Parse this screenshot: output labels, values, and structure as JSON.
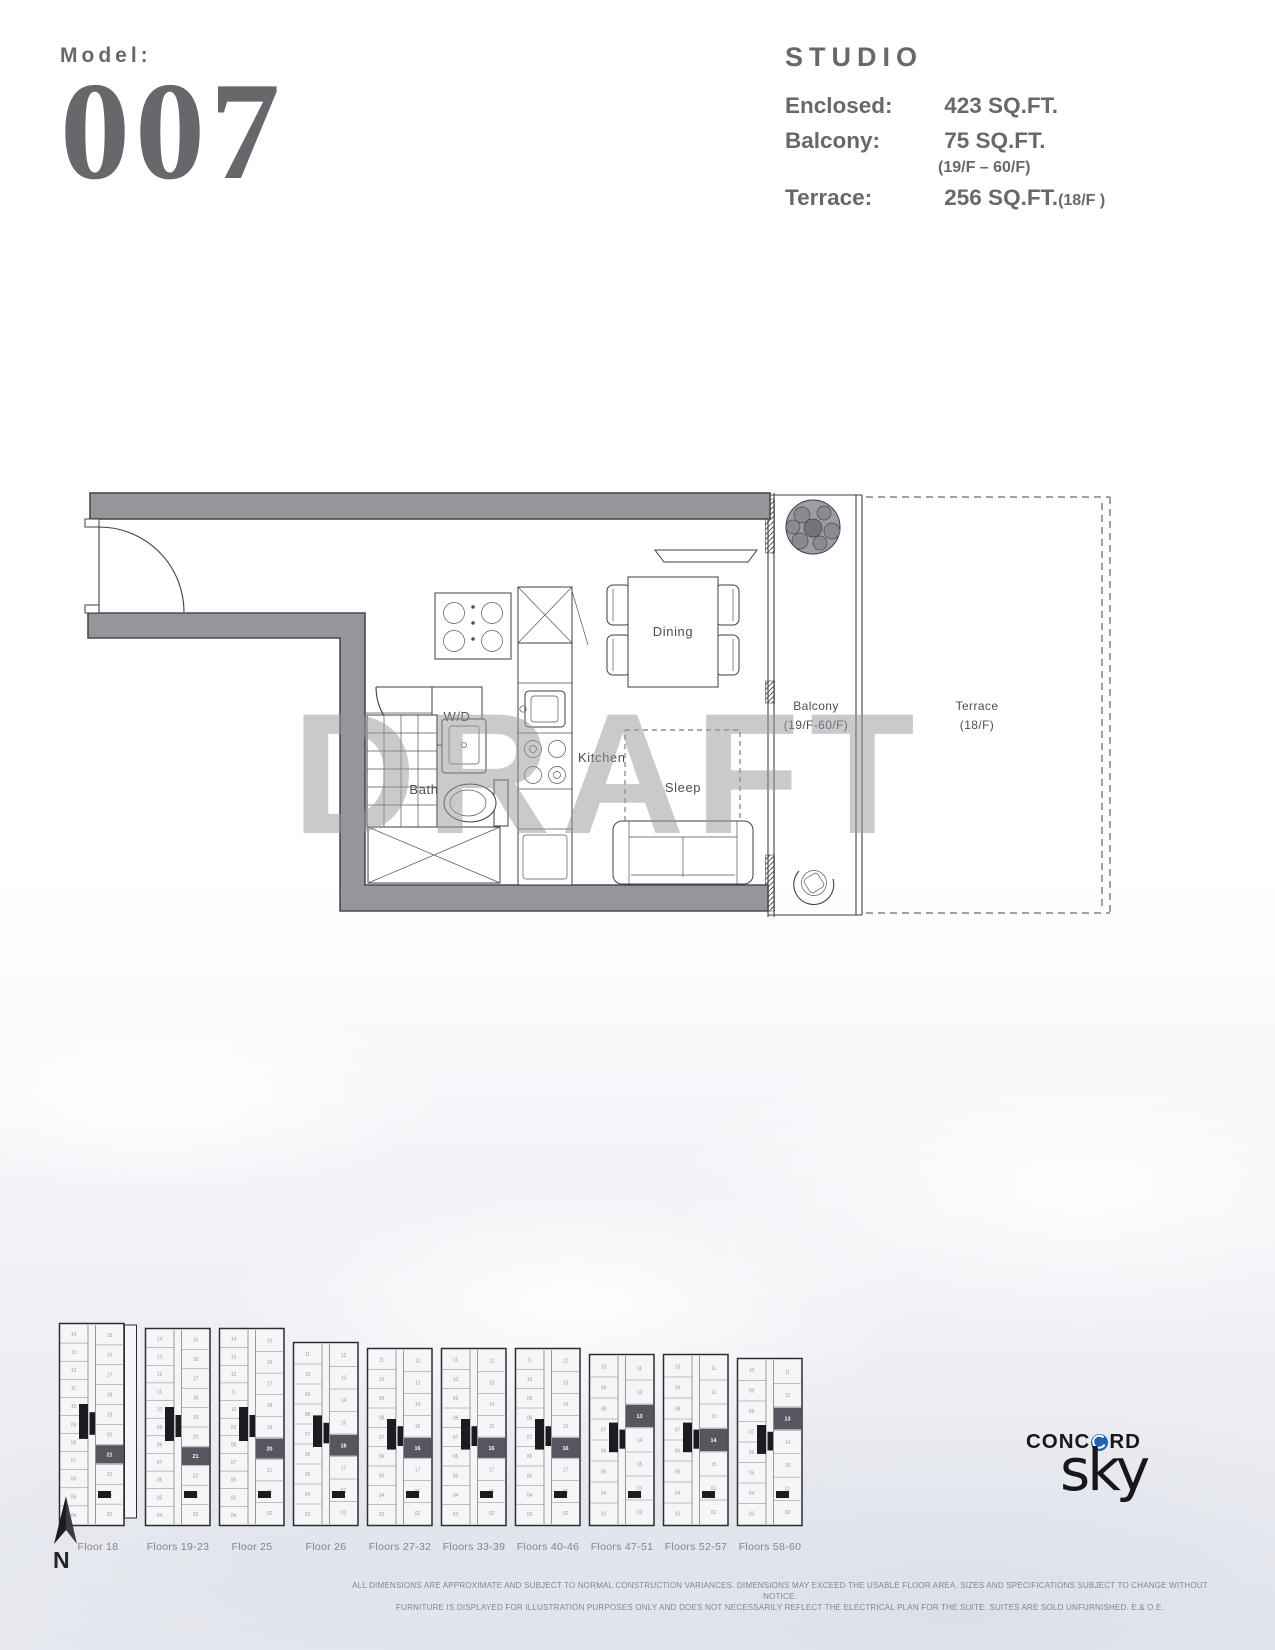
{
  "header": {
    "model_label": "Model:",
    "model_number": "007",
    "unit_type": "STUDIO",
    "specs": [
      {
        "label": "Enclosed:",
        "value": "423 SQ.FT.",
        "note": ""
      },
      {
        "label": "Balcony:",
        "value": "75 SQ.FT.",
        "note": "(19/F – 60/F)"
      },
      {
        "label": "Terrace:",
        "value": "256 SQ.FT.",
        "note": "(18/F )"
      }
    ]
  },
  "floorplan": {
    "watermark": "DRAFT",
    "rooms": {
      "dining": "Dining",
      "kitchen": "Kitchen",
      "bath": "Bath",
      "wd": "W/D",
      "sleep": "Sleep",
      "balcony_line1": "Balcony",
      "balcony_line2": "(19/F-60/F)",
      "terrace_line1": "Terrace",
      "terrace_line2": "(18/F)"
    }
  },
  "keyplans": {
    "items": [
      {
        "label": "Floor 18",
        "height": 205,
        "terrace_strip": true,
        "left": [
          "14",
          "13",
          "12",
          "11",
          "10",
          "09",
          "08",
          "07",
          "06",
          "05",
          "04"
        ],
        "right": [
          "15",
          "16",
          "17",
          "18",
          "19",
          "20",
          "21",
          "22",
          "01",
          "02"
        ],
        "highlight": "21",
        "highlight_index": 6
      },
      {
        "label": "Floors 19-23",
        "height": 200,
        "left": [
          "14",
          "13",
          "12",
          "11",
          "10",
          "09",
          "08",
          "07",
          "06",
          "05",
          "04"
        ],
        "right": [
          "15",
          "16",
          "17",
          "18",
          "19",
          "20",
          "21",
          "22",
          "01",
          "02"
        ],
        "highlight": "21",
        "highlight_index": 6
      },
      {
        "label": "Floor 25",
        "height": 200,
        "left": [
          "14",
          "13",
          "12",
          "11",
          "10",
          "09",
          "08",
          "07",
          "06",
          "05",
          "04"
        ],
        "right": [
          "15",
          "16",
          "17",
          "18",
          "19",
          "20",
          "21",
          "01",
          "02"
        ],
        "highlight": "20",
        "highlight_index": 5
      },
      {
        "label": "Floor 26",
        "height": 186,
        "left": [
          "11",
          "10",
          "09",
          "08",
          "07",
          "06",
          "05",
          "04",
          "03"
        ],
        "right": [
          "12",
          "13",
          "14",
          "15",
          "16",
          "17",
          "01",
          "02"
        ],
        "highlight": "16",
        "highlight_index": 4
      },
      {
        "label": "Floors 27-32",
        "height": 180,
        "left": [
          "11",
          "10",
          "09",
          "08",
          "07",
          "06",
          "05",
          "04",
          "03"
        ],
        "right": [
          "12",
          "13",
          "14",
          "15",
          "16",
          "17",
          "01",
          "02"
        ],
        "highlight": "16",
        "highlight_index": 4
      },
      {
        "label": "Floors 33-39",
        "height": 180,
        "left": [
          "11",
          "10",
          "09",
          "08",
          "07",
          "06",
          "05",
          "04",
          "03"
        ],
        "right": [
          "12",
          "13",
          "14",
          "15",
          "16",
          "17",
          "01",
          "02"
        ],
        "highlight": "16",
        "highlight_index": 4
      },
      {
        "label": "Floors 40-46",
        "height": 180,
        "left": [
          "11",
          "10",
          "09",
          "08",
          "07",
          "06",
          "05",
          "04",
          "03"
        ],
        "right": [
          "12",
          "13",
          "14",
          "15",
          "16",
          "17",
          "01",
          "02"
        ],
        "highlight": "16",
        "highlight_index": 4
      },
      {
        "label": "Floors 47-51",
        "height": 174,
        "left": [
          "10",
          "09",
          "08",
          "07",
          "06",
          "05",
          "04",
          "03"
        ],
        "right": [
          "11",
          "12",
          "13",
          "14",
          "15",
          "01",
          "02"
        ],
        "highlight": "13",
        "highlight_index": 2
      },
      {
        "label": "Floors 52-57",
        "height": 174,
        "left": [
          "10",
          "09",
          "08",
          "07",
          "06",
          "05",
          "04",
          "03"
        ],
        "right": [
          "11",
          "12",
          "13",
          "14",
          "15",
          "01",
          "02"
        ],
        "highlight": "14",
        "highlight_index": 3
      },
      {
        "label": "Floors 58-60",
        "height": 170,
        "left": [
          "10",
          "09",
          "08",
          "07",
          "06",
          "05",
          "04",
          "03"
        ],
        "right": [
          "11",
          "12",
          "13",
          "14",
          "15",
          "01",
          "02"
        ],
        "highlight": "13",
        "highlight_index": 2
      }
    ]
  },
  "north": {
    "label": "N"
  },
  "logo": {
    "brand_part1": "CONC",
    "brand_part2": "RD",
    "product": "sky"
  },
  "disclaimer": {
    "line1": "ALL DIMENSIONS ARE APPROXIMATE AND SUBJECT TO NORMAL CONSTRUCTION VARIANCES. DIMENSIONS MAY EXCEED THE USABLE FLOOR AREA. SIZES AND SPECIFICATIONS SUBJECT TO CHANGE WITHOUT NOTICE.",
    "line2": "FURNITURE IS DISPLAYED FOR ILLUSTRATION PURPOSES ONLY AND DOES NOT NECESSARILY REFLECT THE ELECTRICAL PLAN FOR THE SUITE. SUITES ARE SOLD UNFURNISHED. E.& O.E."
  },
  "colors": {
    "heading_gray": "#68686c",
    "wall_gray": "#95959a",
    "accent_blue": "#1e63ae",
    "watermark_gray": "#9696a0"
  }
}
